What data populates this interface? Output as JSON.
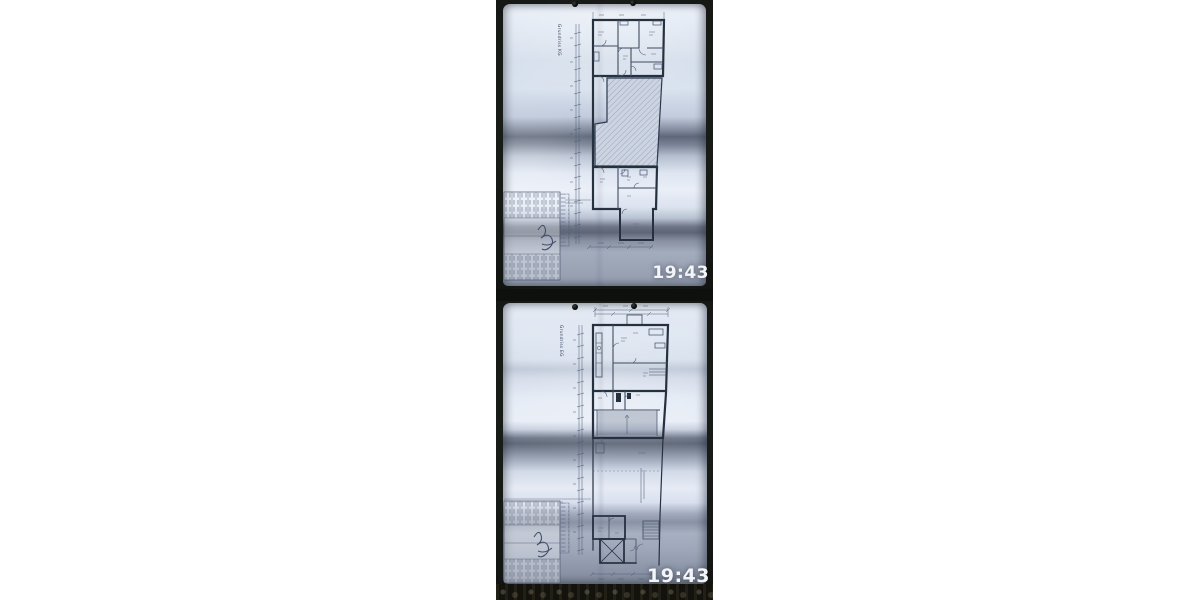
{
  "screen": {
    "background": "#ffffff"
  },
  "photo_strip": {
    "photo_1": {
      "type": "floor-plan-photo",
      "plan_label": "Grundriss KG",
      "timestamp": "19:43"
    },
    "photo_2": {
      "type": "floor-plan-photo",
      "plan_label": "Grundriss EG",
      "timestamp": "19:43"
    }
  },
  "colors": {
    "photo_background": "#141713",
    "paper_highlight": "#e9eef7",
    "paper_fold_shadow": "#5f687a",
    "plan_ink": "#26313f",
    "timestamp": "#f3f5f8"
  }
}
